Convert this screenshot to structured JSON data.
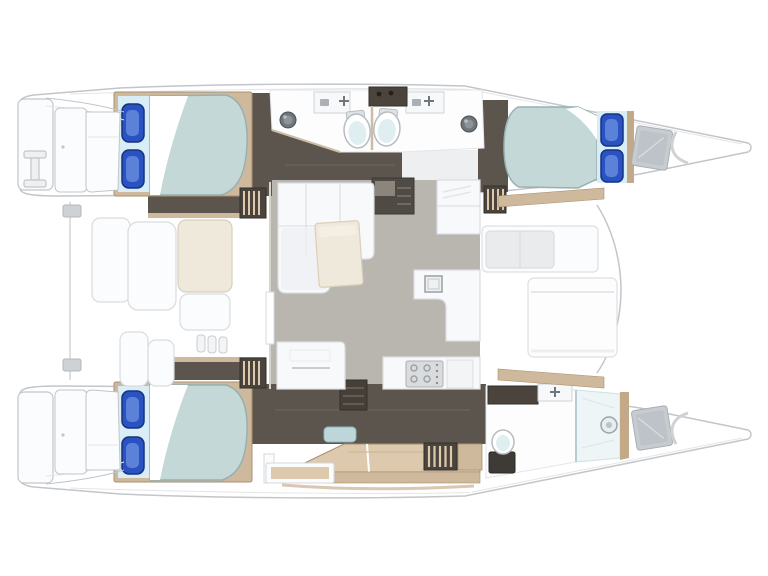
{
  "title": "Catamaran interior layout floor plan, top-down view, bows pointing right",
  "diagram": {
    "type": "floor-plan",
    "subject": "sailing catamaran interior layout",
    "orientation": "bows right, transom platforms left",
    "hulls": 2,
    "double_berths": 3,
    "toilets": 3,
    "wash_basins": 2,
    "sink_counters": 3,
    "shower_compartments": 1,
    "deck_hatches": 2,
    "salon": "central bridgedeck with L-shaped sofa, coffee table and galley with stove and sinks",
    "aft_cockpit": "left of salon with bench seats and lockers",
    "forward_lounge": "right of salon with bench seat and sun pad",
    "port_hull": "two double cabins with shared back-to-back bathrooms amidships",
    "starboard_hull": "owner cabin aft, desk amidships, bathroom with shower forward"
  },
  "icons": [
    {
      "name": "boarding-ladder-icon",
      "depicts": "I-shaped transom boarding ladder"
    },
    {
      "name": "faucet-cross-icon",
      "depicts": "tap on sink counter"
    },
    {
      "name": "toilet-icon",
      "depicts": "marine toilet bowl"
    },
    {
      "name": "basin-icon",
      "depicts": "round wash basin"
    },
    {
      "name": "stove-icon",
      "depicts": "galley stove with four burners"
    },
    {
      "name": "deck-hatch-icon",
      "depicts": "foredeck storage hatch"
    },
    {
      "name": "shower-head-icon",
      "depicts": "shower drain/fixture"
    },
    {
      "name": "pillow-icon",
      "depicts": "blue berth pillow"
    }
  ],
  "colors": {
    "bg": "#ffffff",
    "outline": "#c2c6ca",
    "outline_soft": "#e3e5e8",
    "panel_white": "#fbfcfd",
    "panel_shade": "#edeff1",
    "dark_floor": "#5c554d",
    "dark_floor_line": "#6d665e",
    "darker_unit": "#4a443c",
    "unit_edge": "#332f2b",
    "wood": "#cfb99d",
    "wood_light": "#dcc9ae",
    "wood_dark": "#a98f6f",
    "wood_wall": "#c3a988",
    "blanket": "#c5d8d8",
    "blanket_edge": "#96b0b2",
    "pillow_zone": "#d8edf6",
    "pillow_blue": "#2b52c2",
    "pillow_blue_dark": "#16337f",
    "pillow_blue_light": "#6e92e0",
    "salon_floor": "#b9b6af",
    "cream": "#efe9db",
    "cream_edge": "#d9cfba",
    "steel": "#70777c",
    "steel_dark": "#4a5054",
    "steel_light": "#b9c0c4",
    "hatch_gray": "#c7ccd0",
    "hatch_inner": "#bdc3c8",
    "glass": "#eef5f6",
    "glass_edge": "#b8cdd2",
    "toilet_lid": "#dfeef0",
    "fixture_edge": "#b6bcc0",
    "seat_seam": "#d9dcdf",
    "stove_gray": "#d9dbdd",
    "stove_edge": "#aab0b5"
  }
}
